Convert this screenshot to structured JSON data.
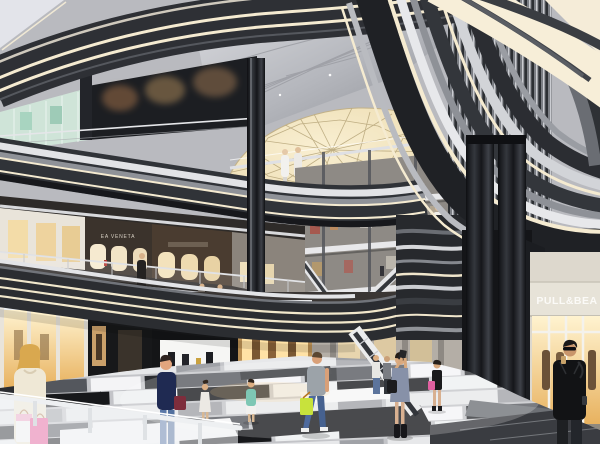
{
  "scene": {
    "type": "architectural-rendering",
    "description": "Multi-level shopping mall atrium with curved LED-lit balcony ribbons, geodesic skylight, storefronts and shoppers on a patchwork tile floor",
    "signs": {
      "bottega": "EA VENETA",
      "boutique": "BYREDO",
      "pullbear": "PULL&BEA"
    },
    "palette": {
      "band_dark": "#2b2d31",
      "band_light": "#e7e8eb",
      "led_warm": "#f5ebd1",
      "ceiling_silver": "#b9bbc1",
      "dome_glow": "#f4e8c9",
      "shop_warm": "#ffe2a6",
      "floor_dark": "#17181b",
      "floor_light": "#f2f2f3",
      "corner_bg": "#e3e4ea",
      "accent_pink": "#e8559a",
      "accent_lime": "#c8e23c",
      "accent_burgundy": "#7e2d3c"
    },
    "people": [
      "blonde woman with pink shopping bags",
      "woman in navy top with burgundy handbag",
      "man in grey t-shirt with lime bag",
      "woman taking a photo",
      "man in black jacket with phone and coffee",
      "shoppers on upper walkways and escalators"
    ]
  }
}
